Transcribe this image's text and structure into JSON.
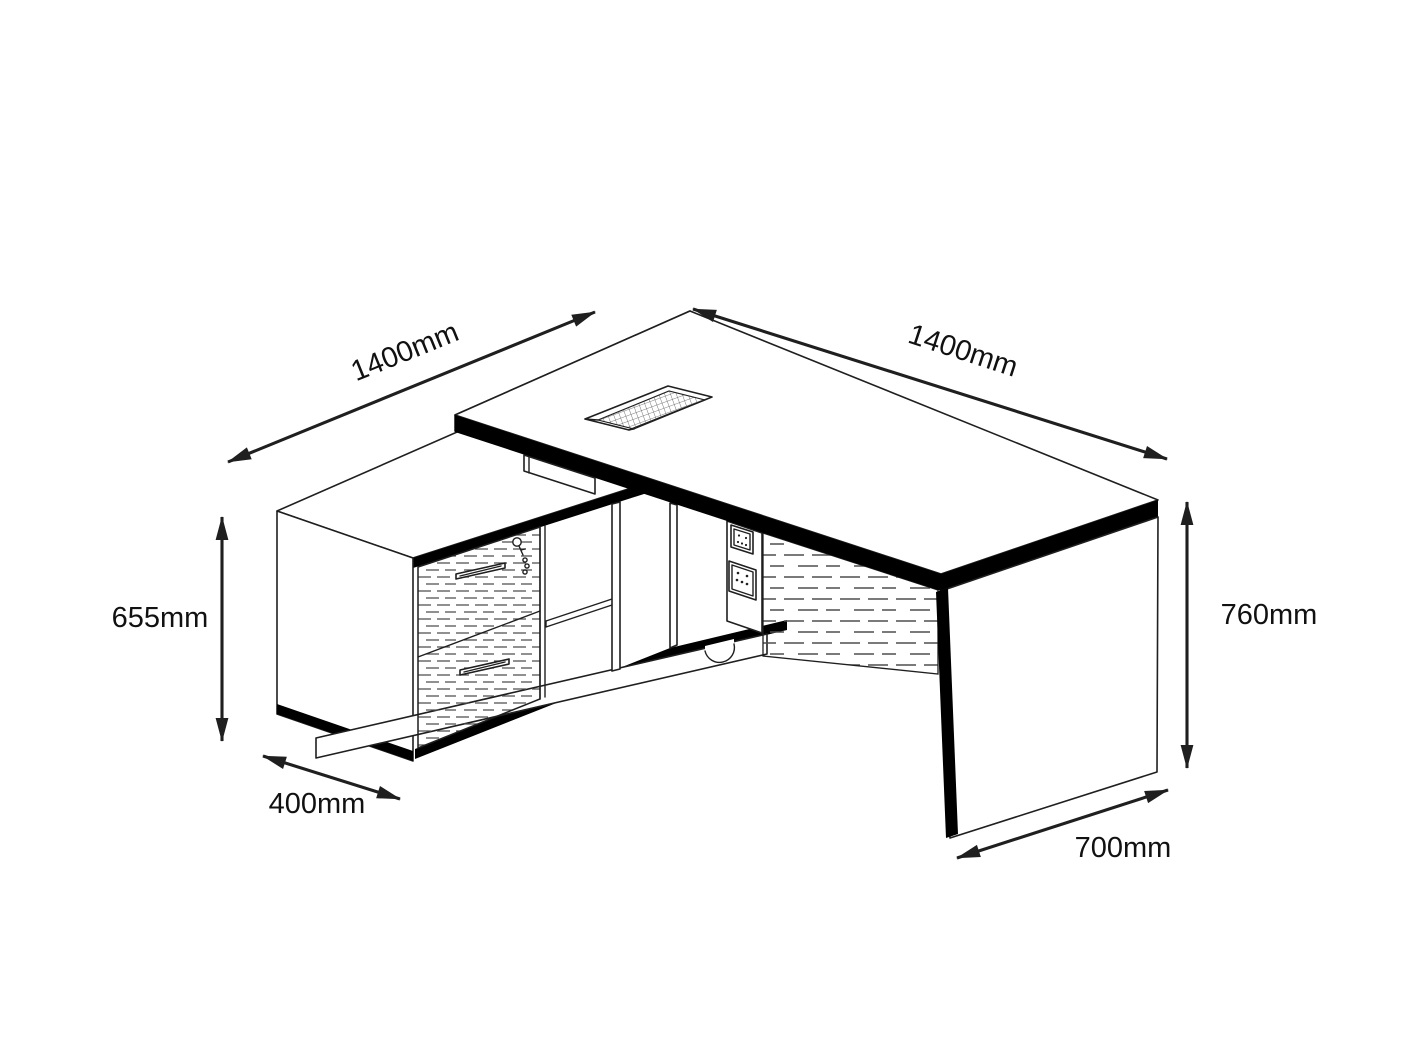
{
  "page": {
    "background": "#ffffff"
  },
  "diagram": {
    "type": "isometric-dimension-drawing",
    "subject": "L-shaped executive office desk with return storage cabinet",
    "dimensions": {
      "return_length": "1400mm",
      "desk_length": "1400mm",
      "cabinet_height": "655mm",
      "cabinet_depth": "400mm",
      "desk_height": "760mm",
      "desk_depth": "700mm"
    },
    "colors": {
      "bg": "#ffffff",
      "line": "#1f1f1f",
      "band": "#000000",
      "texture": "#4d4d4d",
      "label": "#111111"
    }
  }
}
